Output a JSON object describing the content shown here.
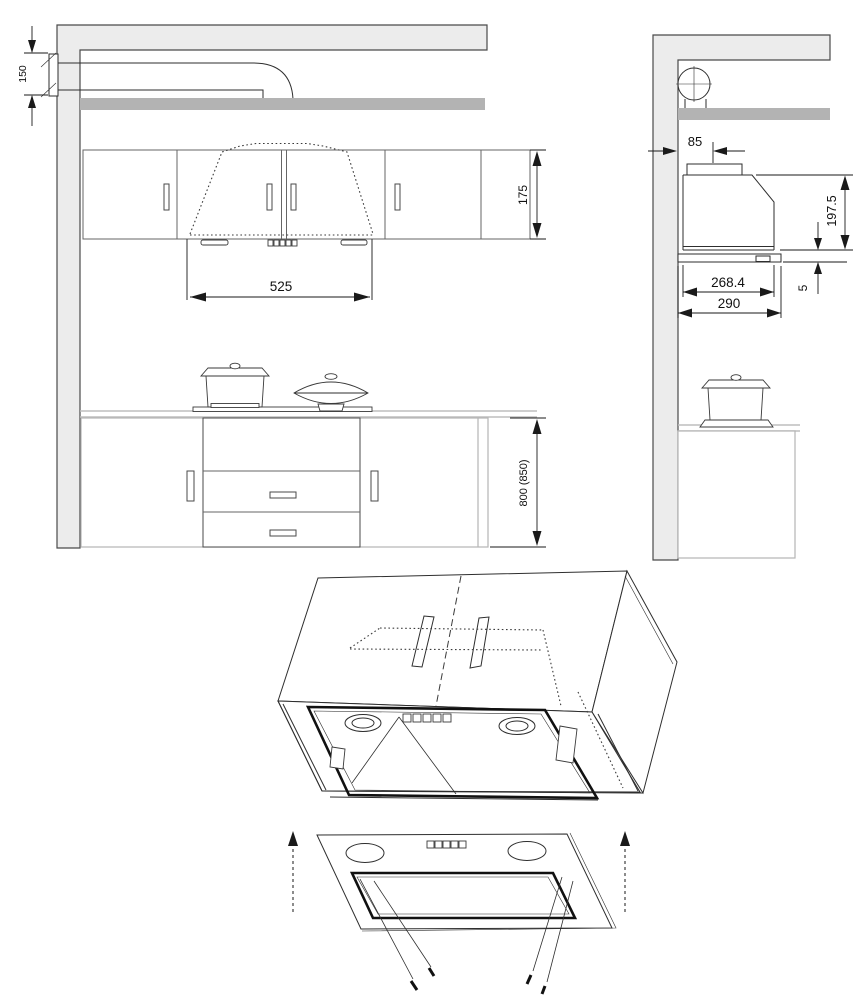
{
  "figure": {
    "front_view": {
      "duct_height": "150",
      "upper_cabinet_height": "175",
      "hood_width": "525",
      "worktop_height": "800 (850)"
    },
    "side_view": {
      "wall_to_duct": "85",
      "hood_height": "197.5",
      "panel_offset": "5",
      "hood_body_depth": "268.4",
      "hood_panel_depth": "290"
    }
  },
  "colors": {
    "line": "#2e2e2e",
    "wall_fill": "#ececec",
    "shelf_fill": "#b3b3b3",
    "dimension": "#1a1a1a",
    "background": "#ffffff"
  }
}
